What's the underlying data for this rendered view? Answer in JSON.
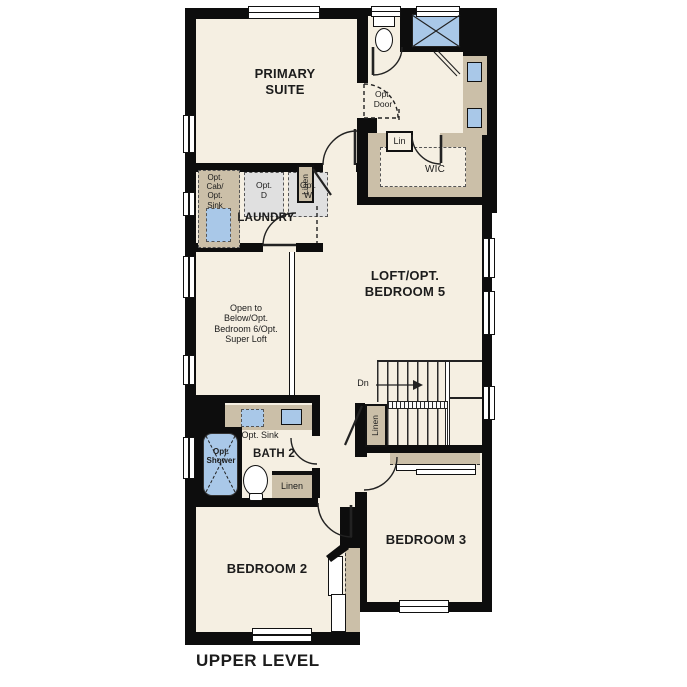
{
  "title": "UPPER LEVEL",
  "colors": {
    "wall": "#0d0d0d",
    "floor": "#f5efe2",
    "cabinet": "#cbbfa8",
    "fixture": "#a9c8e8",
    "paper": "#ffffff",
    "ink": "#1c1c1c"
  },
  "rooms": {
    "primary_suite": "PRIMARY SUITE",
    "laundry": "LAUNDRY",
    "wic": "WIC",
    "loft": "LOFT/OPT. BEDROOM 5",
    "open_to_below": "Open to Below/Opt. Bedroom 6/Opt. Super Loft",
    "bath2": "BATH 2",
    "bedroom2": "BEDROOM 2",
    "bedroom3": "BEDROOM 3"
  },
  "features": {
    "opt_door": "Opt. Door",
    "lin": "Lin",
    "hall_linen": "Linen",
    "stairs_linen": "Linen",
    "bath_linen": "Linen",
    "opt_cab_sink": "Opt. Cab/ Opt. Sink",
    "opt_dryer": "Opt. D",
    "opt_washer": "Opt. W",
    "opt_sink": "Opt. Sink",
    "opt_shower": "Opt. Shower",
    "stairs_down": "Dn"
  }
}
